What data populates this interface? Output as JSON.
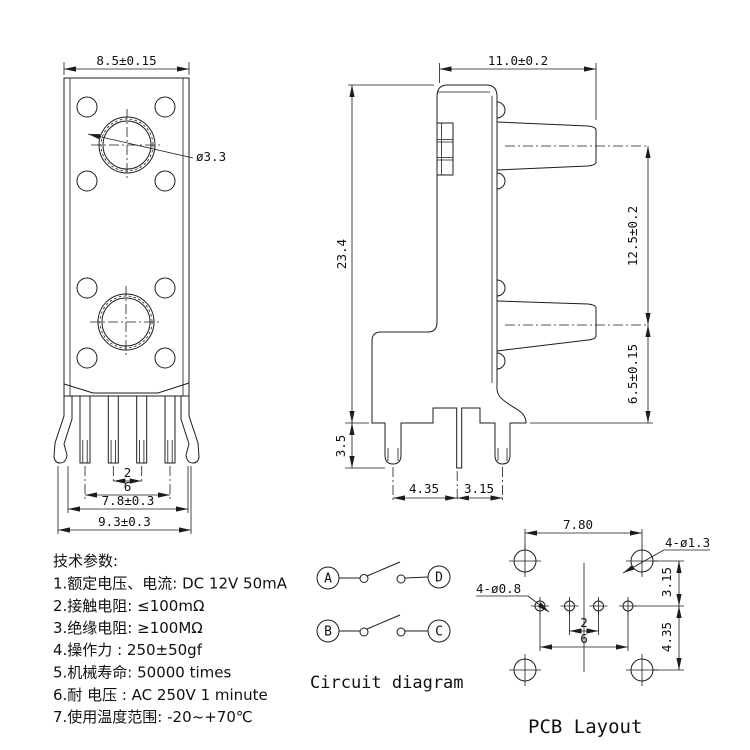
{
  "front_view": {
    "width_dim": "8.5±0.15",
    "hole_dia": "ø3.3",
    "pin_pitch_dim": "2",
    "pin_span_dim": "6",
    "leg_span_dim": "7.8±0.3",
    "outer_span_dim": "9.3±0.3"
  },
  "side_view": {
    "depth_dim": "11.0±0.2",
    "height_dim": "23.4",
    "button_pitch_dim": "12.5±0.2",
    "button_offset_dim": "6.5±0.15",
    "pin_length_dim": "3.5",
    "pin_spacing_left_dim": "4.35",
    "pin_spacing_right_dim": "3.15"
  },
  "tech_specs": {
    "title": "技术参数:",
    "items": [
      "1.额定电压、电流: DC 12V 50mA",
      "2.接触电阻: ≤100mΩ",
      "3.绝缘电阻: ≥100MΩ",
      "4.操作力 : 250±50gf",
      "5.机械寿命: 50000 times",
      "6.耐 电压 : AC 250V 1 minute",
      "7.使用温度范围: -20~+70℃"
    ]
  },
  "circuit": {
    "terminal_a": "A",
    "terminal_b": "B",
    "terminal_c": "C",
    "terminal_d": "D",
    "caption": "Circuit diagram"
  },
  "pcb": {
    "pitch_dim": "7.80",
    "corner_hole_label": "4-ø1.3",
    "pin_hole_label": "4-ø0.8",
    "row_top_dim": "3.15",
    "row_bottom_dim": "4.35",
    "pin_pitch_dim": "2",
    "pin_span_dim": "6",
    "caption": "PCB Layout"
  },
  "colors": {
    "line": "#1c1c1c",
    "background": "#ffffff"
  }
}
